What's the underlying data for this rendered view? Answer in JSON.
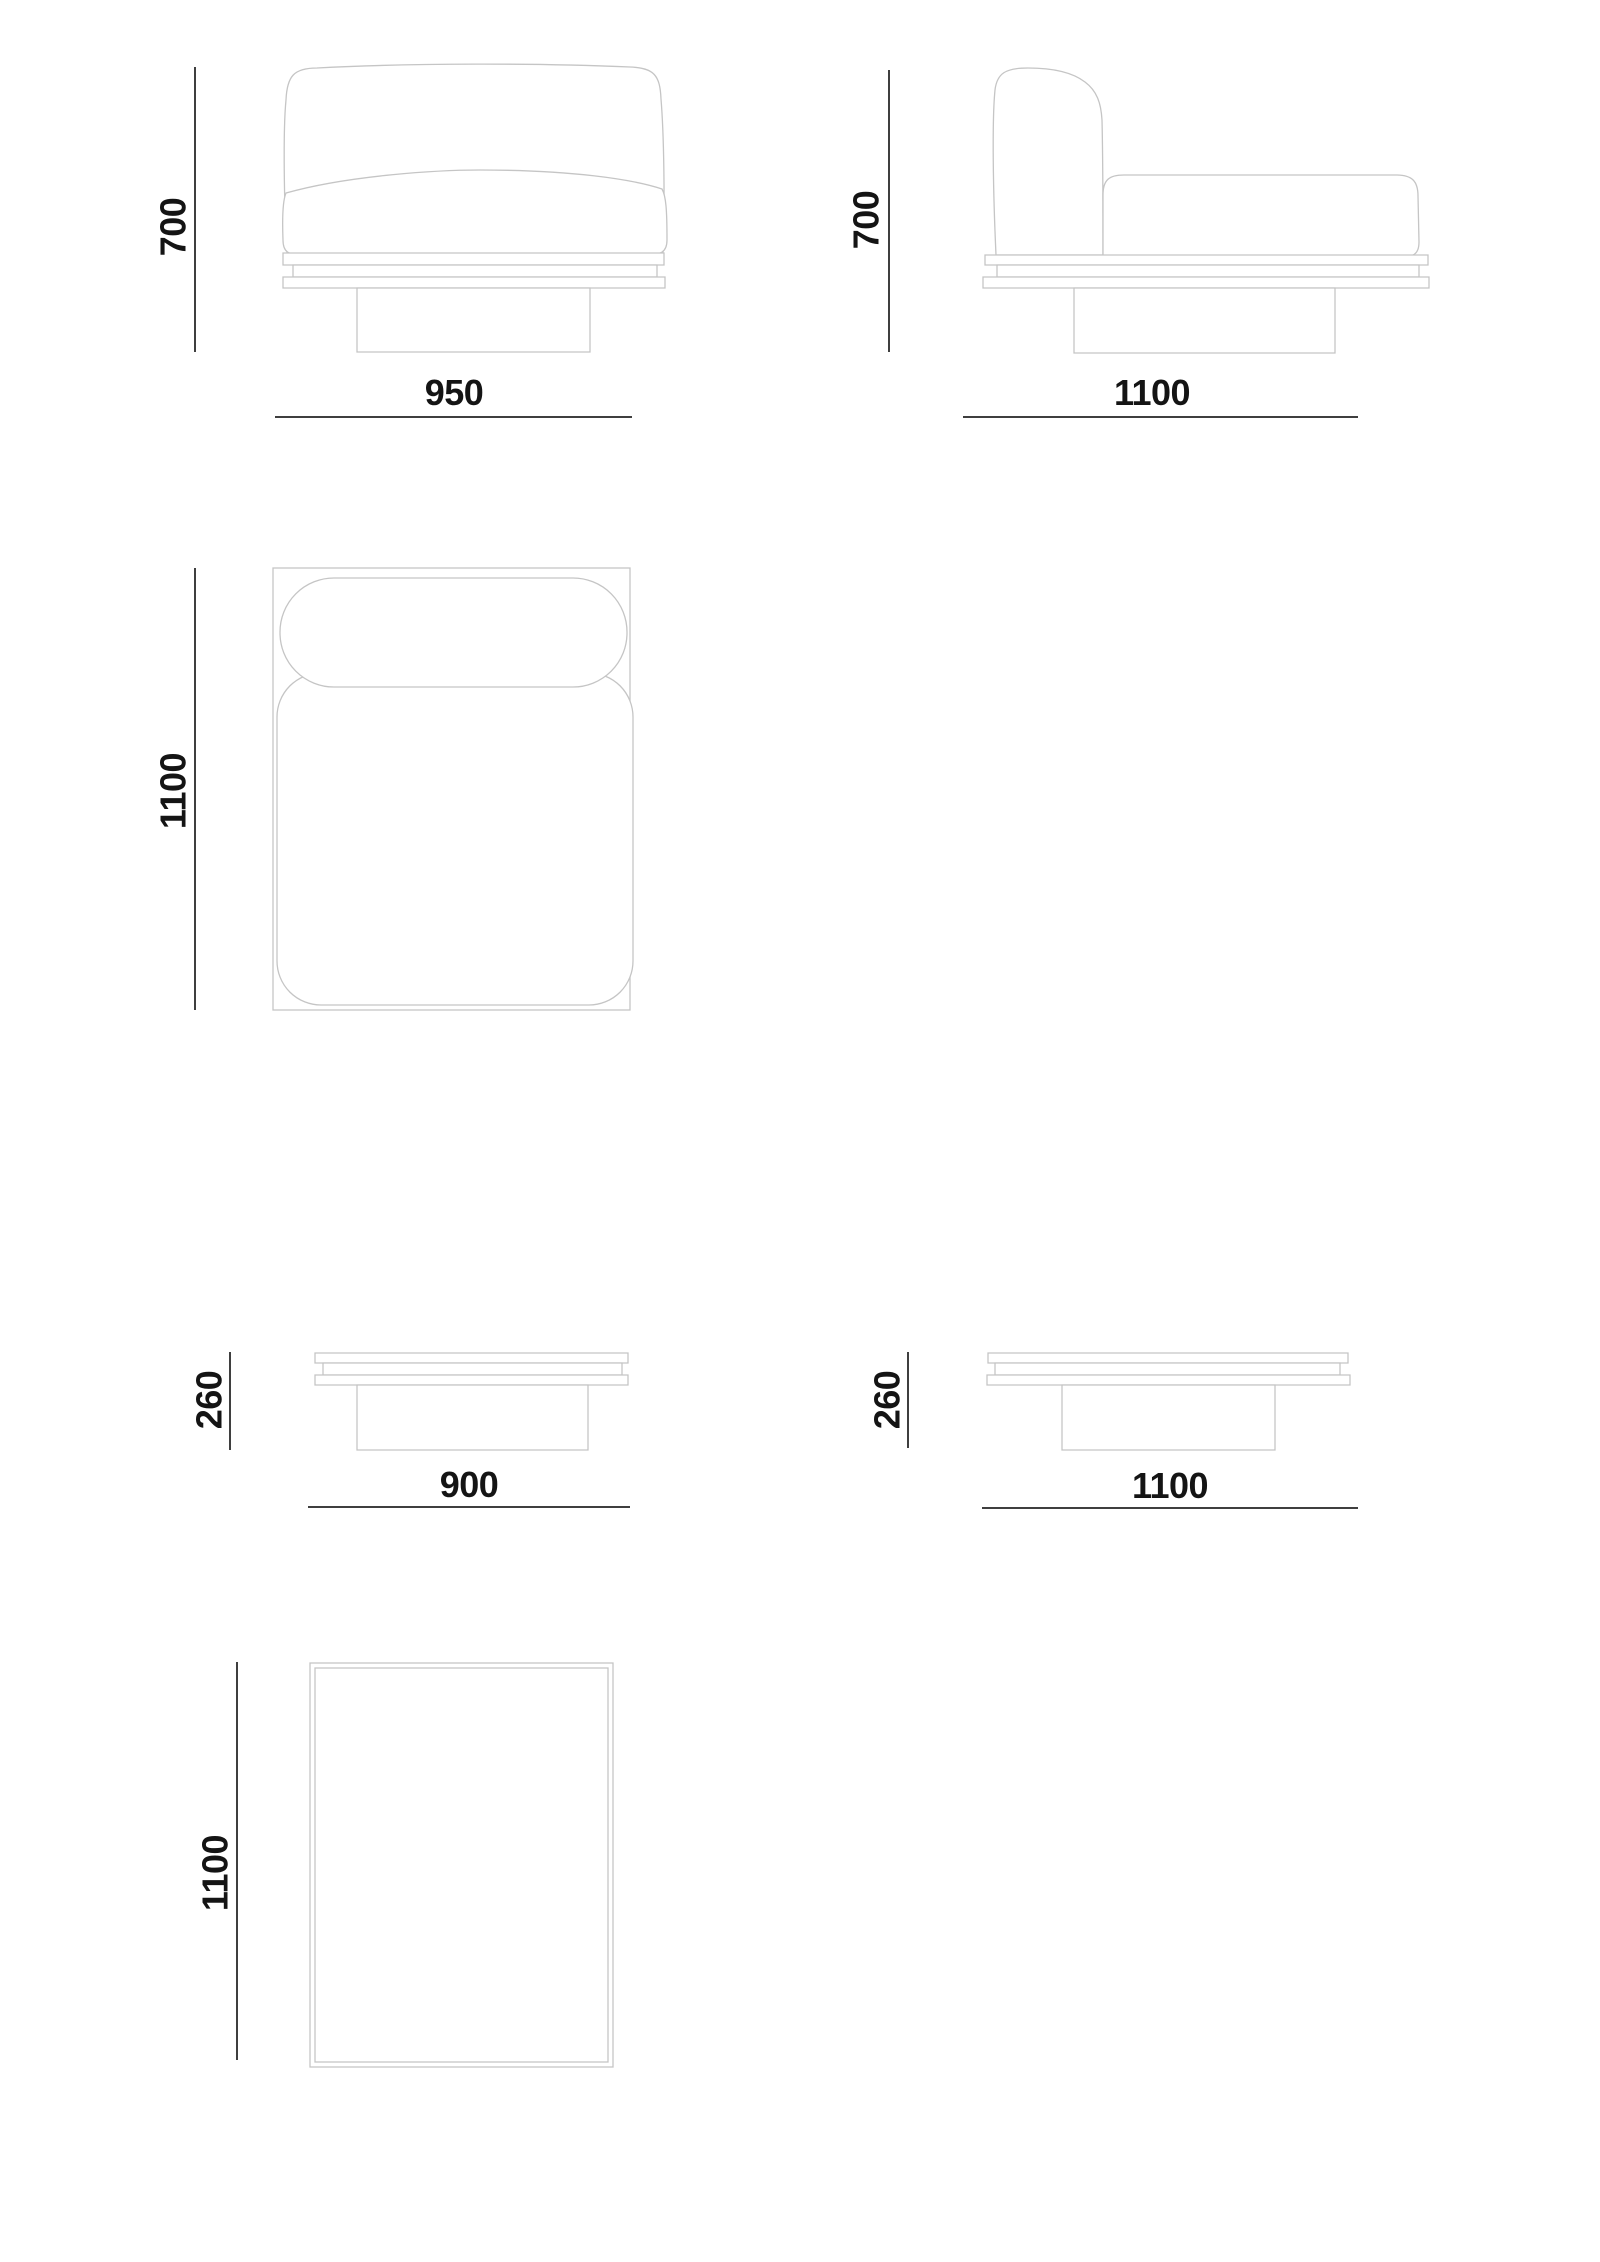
{
  "page": {
    "kind": "furniture technical dimension drawing",
    "colors": {
      "background": "#ffffff",
      "artwork_line": "#c5c5c5",
      "dimension_line": "#3f3f3f",
      "text": "#141414"
    }
  },
  "views": {
    "chair_front": {
      "height": "700",
      "width": "950"
    },
    "chair_side": {
      "height": "700",
      "depth": "1100"
    },
    "chair_top": {
      "depth": "1100"
    },
    "table_front": {
      "height": "260",
      "width": "900"
    },
    "table_side": {
      "height": "260",
      "depth": "1100"
    },
    "table_top": {
      "depth": "1100"
    }
  }
}
